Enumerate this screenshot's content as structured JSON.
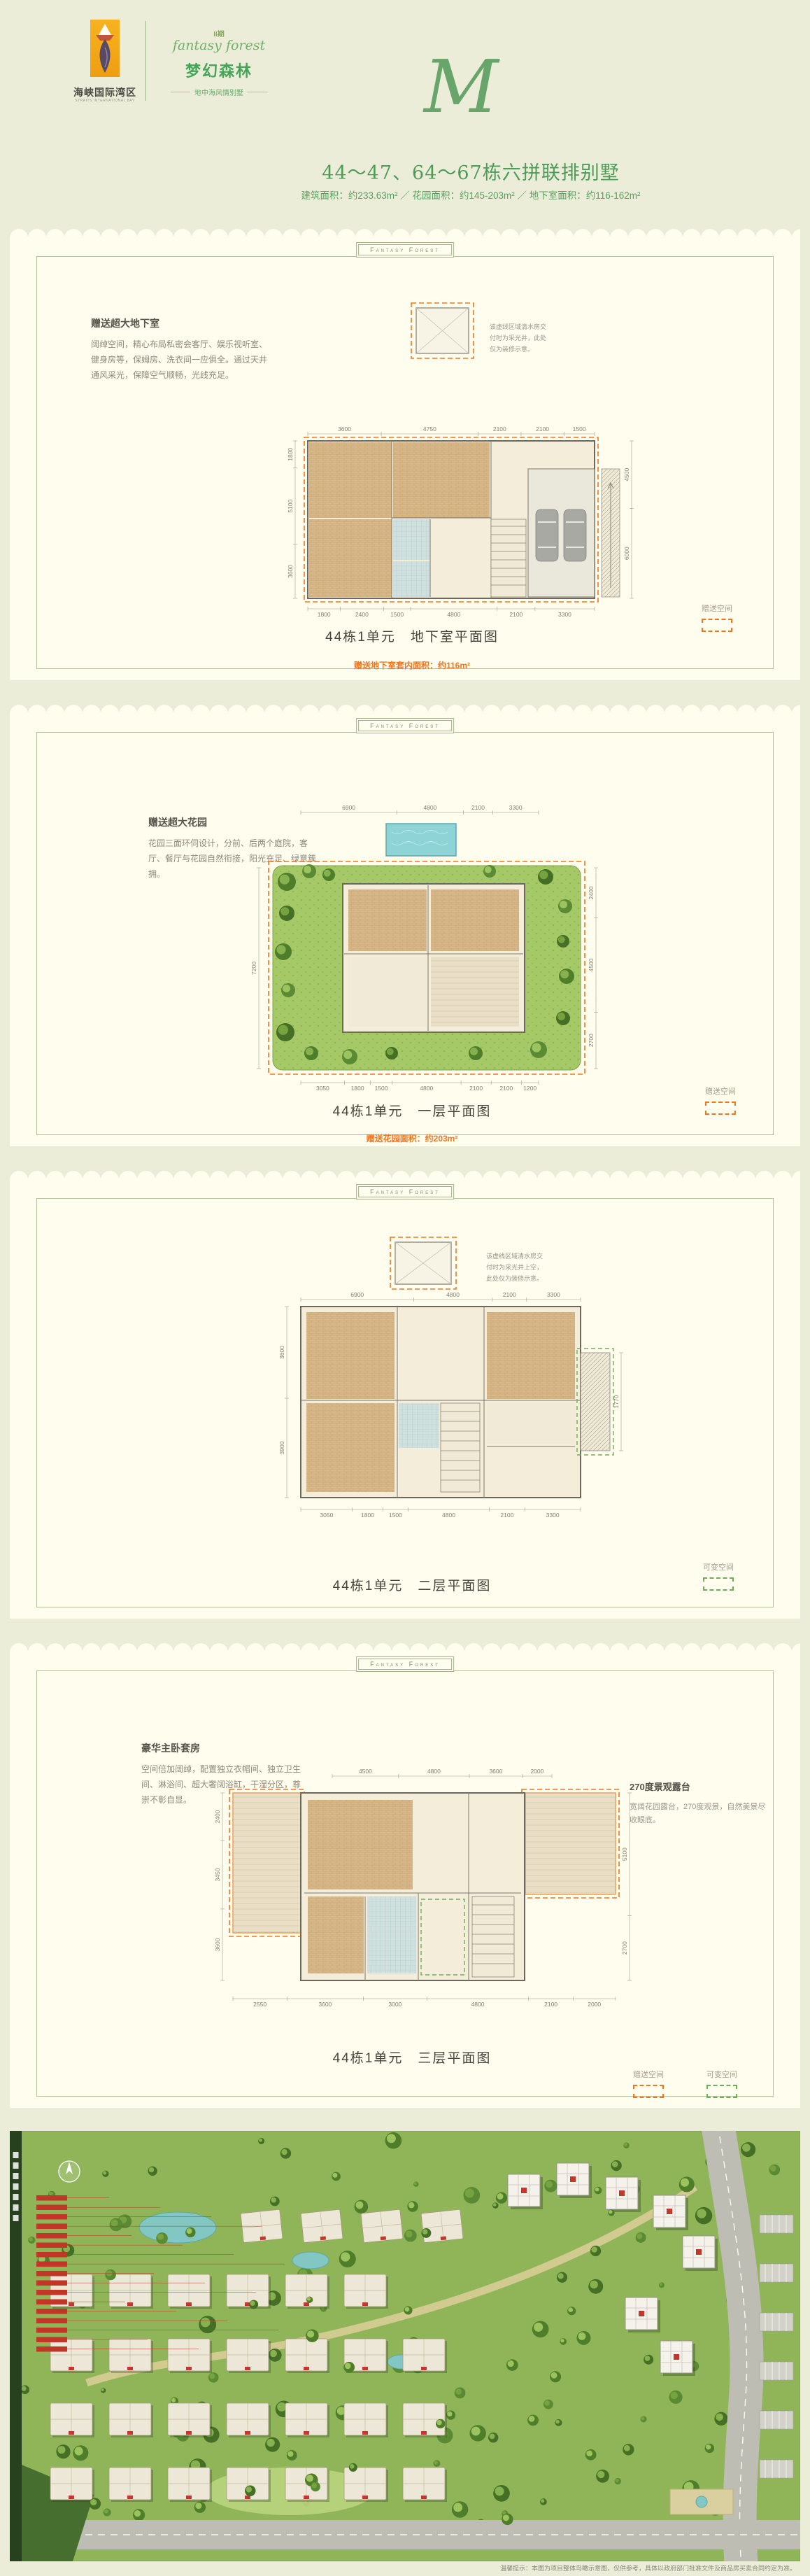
{
  "theme": {
    "page_bg": "#ecedd8",
    "panel_bg": "#fffdee",
    "green": "#4e9c59",
    "orange": "#f0761f",
    "border_green": "#b4c096"
  },
  "header": {
    "logo_brand_cn": "海峡国际湾区",
    "logo_brand_en": "STRAITS INTERNATIONAL BAY",
    "phase": "II期",
    "script_en": "fantasy forest",
    "project_cn": "梦幻森林",
    "tagline": "地中海风情别墅",
    "monogram": "M",
    "title": "44～47、64～67栋六拼联排别墅",
    "subtitle": "建筑面积：约233.63m² ／ 花园面积：约145-203m² ／ 地下室面积：约116-162m²"
  },
  "ribbon": "Fantasy Forest",
  "panels": [
    {
      "feature_title": "赠送超大地下室",
      "feature_body": "阔绰空间，精心布局私密会客厅、娱乐视听室、健身房等，保姆房、洗衣间一应俱全。通过天井通风采光，保障空气顺畅，光线充足。",
      "note": "该虚线区域清水房交付时为采光井，此处仅为装修示意。",
      "caption": "44栋1单元　地下室平面图",
      "caption_sub": "赠送地下室套内面积：约116m²",
      "legends": [
        {
          "label": "赠送空间",
          "style": "orange"
        }
      ],
      "dims_top": [
        3600,
        4750,
        2100,
        2100,
        1500
      ],
      "dims_bottom": [
        1800,
        2400,
        1500,
        4800,
        2100,
        3300
      ],
      "dims_left": [
        1800,
        5100,
        3600
      ],
      "dims_right": [
        4500,
        6000
      ]
    },
    {
      "feature_title": "赠送超大花园",
      "feature_body": "花园三面环伺设计，分前、后两个庭院，客厅、餐厅与花园自然衔接，阳光充足、绿意簇拥。",
      "caption": "44栋1单元　一层平面图",
      "caption_sub": "赠送花园面积：约203m²",
      "legends": [
        {
          "label": "赠送空间",
          "style": "orange"
        }
      ],
      "dims_top": [
        6900,
        4800,
        2100,
        3300
      ],
      "dims_bottom": [
        3050,
        1800,
        1500,
        4800,
        2100,
        2100,
        1200
      ],
      "dims_left": [
        7200
      ],
      "dims_right": [
        2400,
        4500,
        2700
      ]
    },
    {
      "note": "该虚线区域清水房交付时为采光井上空，此处仅为装修示意。",
      "caption": "44栋1单元　二层平面图",
      "legends": [
        {
          "label": "可变空间",
          "style": "green"
        }
      ],
      "dims_top": [
        6900,
        4800,
        2100,
        3300
      ],
      "dims_bottom": [
        3050,
        1800,
        1500,
        4800,
        2100,
        3300
      ],
      "dims_left": [
        3600,
        3900
      ],
      "dims_right": [
        1770
      ]
    },
    {
      "feature_title": "豪华主卧套房",
      "feature_body": "空间倍加阔绰，配置独立衣帽间、独立卫生间、淋浴间、超大奢阔浴缸，干湿分区，尊崇不彰自显。",
      "note_title": "270度景观露台",
      "note": "宽阔花园露台，270度观景，自然美景尽收眼底。",
      "caption": "44栋1单元　三层平面图",
      "legends": [
        {
          "label": "赠送空间",
          "style": "orange"
        },
        {
          "label": "可变空间",
          "style": "green"
        }
      ],
      "dims_top": [
        4500,
        4800,
        3600,
        2000
      ],
      "dims_bottom": [
        2550,
        3600,
        3000,
        4800,
        2100,
        2000
      ],
      "dims_left": [
        2400,
        3450,
        3600
      ],
      "dims_right": [
        5100,
        2700
      ]
    }
  ],
  "siteplan": {
    "disclaimer": "温馨提示：本图为项目整体鸟瞰示意图，仅供参考，具体以政府部门批准文件及商品房买卖合同约定为准。"
  }
}
